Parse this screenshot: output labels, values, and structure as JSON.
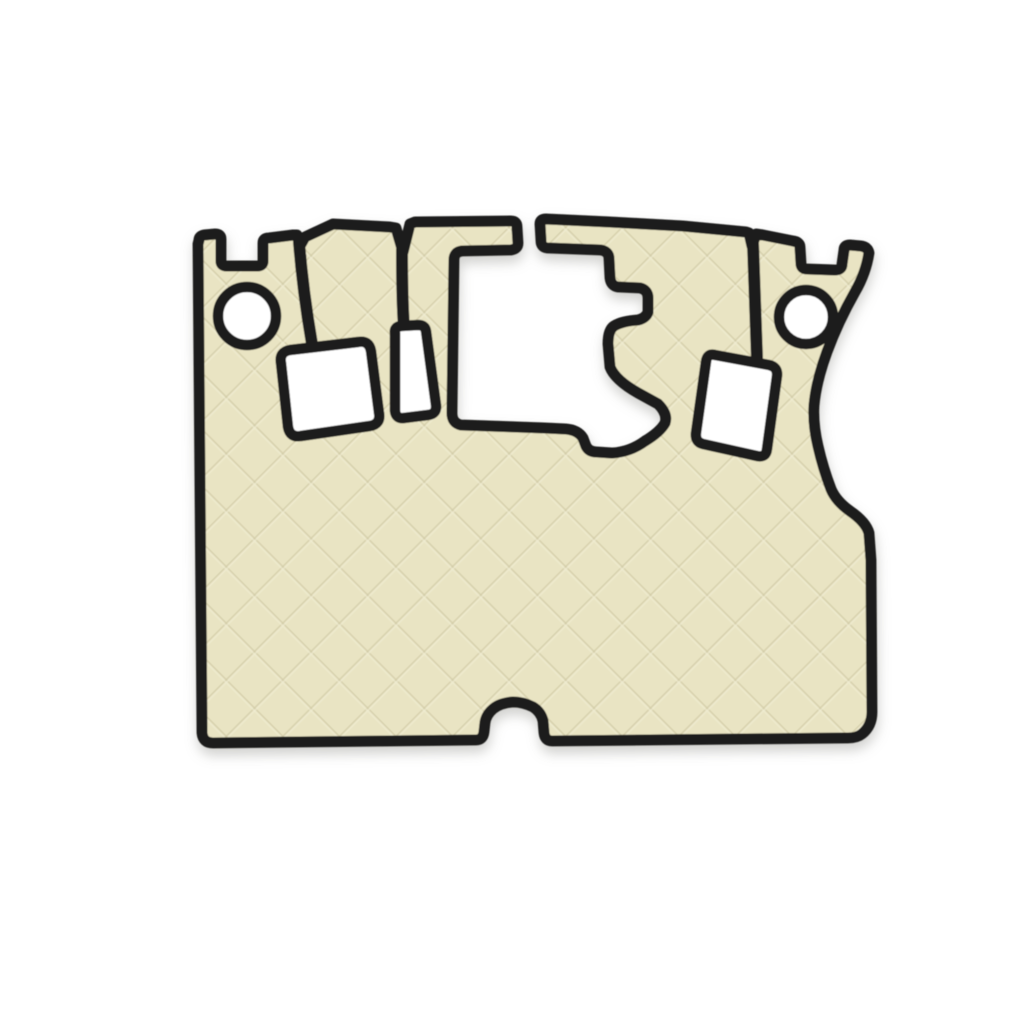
{
  "image": {
    "kind": "product-photo",
    "subject": "quilted-eco-leather-truck-floor-mat",
    "orientation": "mat centered horizontally, upper-middle of frame",
    "colors": {
      "bg-color": "#ffffff",
      "mat-fill": "#e9e4c3",
      "quilt-line-dark": "#d3cda9",
      "quilt-line-light": "#f2eed6",
      "binding-color": "#1d1d1d",
      "shadow-color": "#9a9a94"
    },
    "pattern": {
      "type": "diamond-quilt",
      "line_angle_deg": 45,
      "grid_spacing_px": 40
    },
    "features": {
      "outer_silhouette": "wide mat, notched top tabs left and right, concave curved right edge, small rounded notch centered in bottom edge",
      "cutouts": [
        {
          "name": "left-round-hole",
          "shape": "circle",
          "cx": 247,
          "cy": 316,
          "r": 29
        },
        {
          "name": "right-round-hole",
          "shape": "circle",
          "cx": 806,
          "cy": 317,
          "r": 27
        },
        {
          "name": "left-square-cutout",
          "shape": "rounded-square, rotated slightly counterclockwise",
          "approx_box": [
            277,
            342,
            380,
            438
          ]
        },
        {
          "name": "narrow-slot-cutout",
          "shape": "narrow vertical rounded slot",
          "approx_box": [
            389,
            325,
            437,
            420
          ]
        },
        {
          "name": "center-pedal-cutout",
          "shape": "large opening with stepped right profile and lower-right lobe, open channel to top edge",
          "approx_box": [
            452,
            218,
            668,
            453
          ]
        },
        {
          "name": "right-tilted-cutout",
          "shape": "rounded rectangle, tilted clockwise",
          "approx_box": [
            694,
            354,
            780,
            458
          ]
        }
      ],
      "seams": [
        {
          "name": "seam-left",
          "from": [
            299,
            240
          ],
          "to": [
            312,
            344
          ]
        },
        {
          "name": "seam-middle",
          "from": [
            402,
            250
          ],
          "to": [
            404,
            328
          ]
        },
        {
          "name": "seam-right",
          "from": [
            753,
            242
          ],
          "to": [
            757,
            358
          ]
        }
      ]
    }
  }
}
